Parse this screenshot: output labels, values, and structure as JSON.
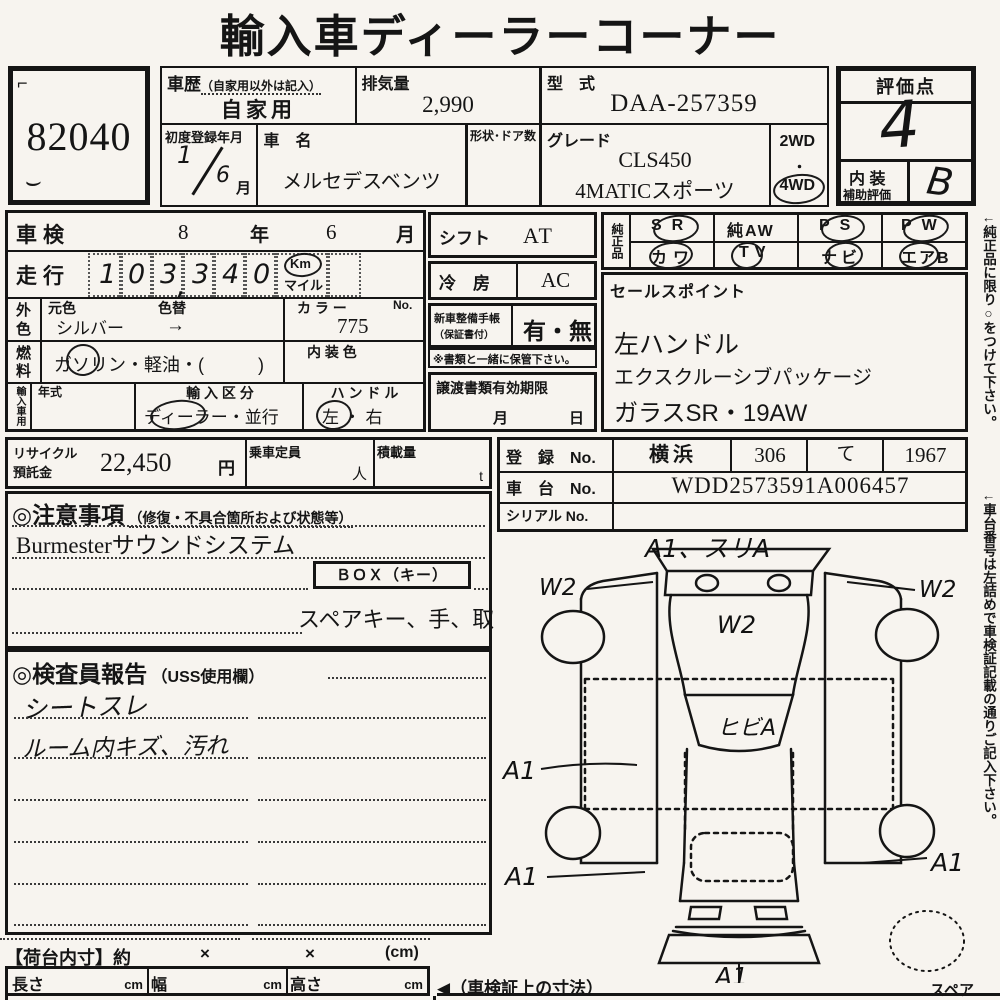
{
  "title": "輸入車ディーラーコーナー",
  "lot_no": "82040",
  "header": {
    "history_label": "車歴",
    "history_note": "（自家用以外は記入）",
    "history_value": "自家用",
    "displacement_label": "排気量",
    "displacement_value": "2,990",
    "model_code_label": "型　式",
    "model_code_value": "DAA-257359",
    "first_reg_label": "初度登録年月",
    "first_reg_year": "1",
    "first_reg_month": "6",
    "first_reg_month_suffix": "月",
    "car_name_label": "車　名",
    "car_name_value": "メルセデスベンツ",
    "shape_doors_label": "形状･ドア数",
    "grade_label": "グレード",
    "grade_line1": "CLS450",
    "grade_line2": "4MATICスポーツ",
    "drive_2wd": "2WD",
    "drive_dot": "・",
    "drive_4wd": "4WD"
  },
  "score": {
    "label": "評価点",
    "value": "4",
    "interior_label_1": "内 装",
    "interior_label_2": "補助評価",
    "interior_value": "B"
  },
  "left_table": {
    "shaken_label": "車検",
    "shaken_year": "8",
    "shaken_year_suffix": "年",
    "shaken_month": "6",
    "shaken_month_suffix": "月",
    "mileage_label": "走行",
    "mileage_digits": [
      "1",
      "0",
      "3",
      "3",
      "4",
      "0"
    ],
    "mileage_comma": ",",
    "mileage_unit_km": "Km",
    "mileage_unit_mile": "マイル",
    "color_label_1": "外",
    "color_label_2": "色",
    "orig_color_label": "元色",
    "orig_color_value": "シルバー",
    "recolor_label": "色替",
    "recolor_arrow": "→",
    "color_no_label": "カ ラ ー",
    "color_no_no": "No.",
    "color_no_value": "775",
    "fuel_label_1": "燃",
    "fuel_label_2": "料",
    "fuel_value": "ガソリン・軽油・(　　　)",
    "interior_color_label": "内 装 色",
    "import_label": "輸入車用",
    "year_type_label": "年式",
    "import_class_label": "輸 入 区 分",
    "import_class_value": "ディーラー・並行",
    "handle_label": "ハ ン ド ル",
    "handle_value": "左 ・ 右"
  },
  "mid": {
    "shift_label": "シフト",
    "shift_value": "AT",
    "ac_label": "冷　房",
    "ac_value": "AC",
    "booklet_label1": "新車整備手帳",
    "booklet_label2": "（保証書付）",
    "booklet_value": "有・無",
    "keep_note": "※書類と一緒に保管下さい。",
    "transfer_label": "譲渡書類有効期限",
    "transfer_month": "月",
    "transfer_day": "日"
  },
  "genuine": {
    "label": "純正品",
    "items": [
      {
        "text": "SR",
        "circled": true
      },
      {
        "text": "純AW",
        "circled": false
      },
      {
        "text": "PS",
        "circled": true
      },
      {
        "text": "PW",
        "circled": true
      },
      {
        "text": "カワ",
        "circled": true
      },
      {
        "text": "TV",
        "circled": true
      },
      {
        "text": "ナビ",
        "circled": true
      },
      {
        "text": "エアB",
        "circled": true
      }
    ]
  },
  "sales": {
    "label": "セールスポイント",
    "lines": [
      "左ハンドル",
      "エクスクルーシブパッケージ",
      "ガラスSR・19AW"
    ]
  },
  "registration": {
    "reg_label": "登　録　No.",
    "reg_area": "横浜",
    "reg_class": "306",
    "reg_kana": "て",
    "reg_num": "1967",
    "chassis_label": "車　台　No.",
    "chassis_value": "WDD2573591A006457",
    "serial_label": "シリアル No."
  },
  "recycle": {
    "label1": "リサイクル",
    "label2": "預託金",
    "value": "22,450",
    "unit": "円",
    "capacity_label": "乗車定員",
    "capacity_unit": "人",
    "load_label": "積載量",
    "load_unit": "t"
  },
  "notes": {
    "header": "◎注意事項",
    "header_note": "（修復・不具合箇所および状態等）",
    "line1": "Burmesterサウンドシステム",
    "box_label": "ＢＯＸ（キー）",
    "line2": "スペアキー、手、取"
  },
  "inspector": {
    "header": "◎検査員報告",
    "header_note": "（USS使用欄）",
    "notes": [
      "シートスレ",
      "ルーム内キズ、汚れ"
    ]
  },
  "cargo": {
    "header": "【荷台内寸】約",
    "x1": "×",
    "x2": "×",
    "unit": "(cm)",
    "length_label": "長さ",
    "width_label": "幅",
    "height_label": "高さ",
    "cm": "cm",
    "dims_note": "◀（車検証上の寸法）"
  },
  "diagram": {
    "annotations": {
      "top": "A1、スリA",
      "left_w2": "W2",
      "right_w2": "W2",
      "hood_w2": "W2",
      "windshield": "ヒビA",
      "left_a1": "A1",
      "left_a1b": "A1",
      "right_a1": "A1",
      "bottom_a1": "A1",
      "spare": "スペア"
    }
  },
  "side_notes": {
    "note1": "←純正品に限り○をつけて下さい。",
    "note2": "←車台番号は左詰めで車検証記載の通りご記入下さい。"
  }
}
